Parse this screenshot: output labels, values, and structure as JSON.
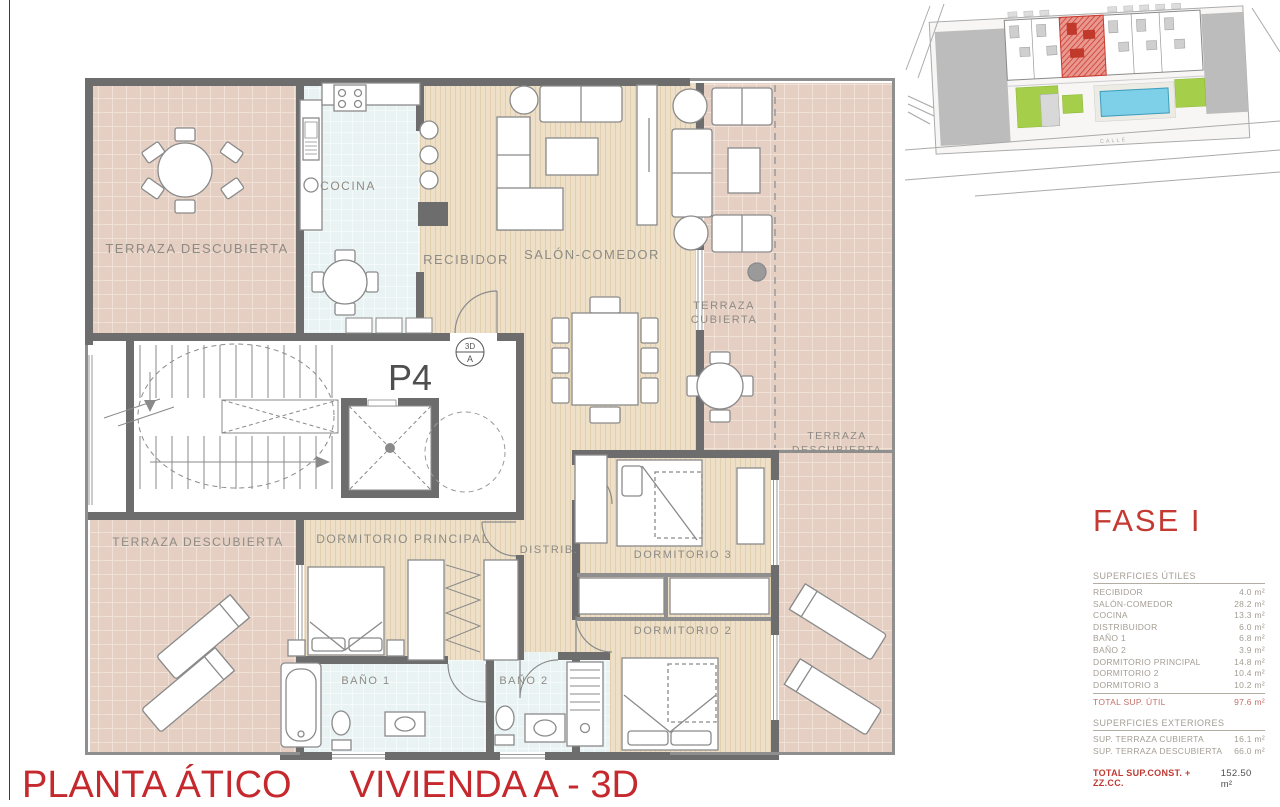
{
  "titles": {
    "plan_title": "PLANTA ÁTICO",
    "unit_title": "VIVIENDA A - 3D",
    "phase": "FASE I"
  },
  "floorplan": {
    "unit_label": "P4",
    "camera_marker": {
      "line1": "3D",
      "line2": "A"
    },
    "rooms": {
      "terraza_tl": "TERRAZA DESCUBIERTA",
      "cocina": "COCINA",
      "recibidor": "RECIBIDOR",
      "salon": "SALÓN-COMEDOR",
      "terraza_cub_1": "TERRAZA",
      "terraza_cub_2": "CUBIERTA",
      "terraza_der_1": "TERRAZA",
      "terraza_der_2": "DESCUBIERTA",
      "terraza_bl": "TERRAZA DESCUBIERTA",
      "dorm_principal": "DORMITORIO PRINCIPAL",
      "distrib": "DISTRIB.",
      "dorm3": "DORMITORIO 3",
      "dorm2": "DORMITORIO 2",
      "bano1": "BAÑO 1",
      "bano2": "BAÑO 2"
    }
  },
  "siteplan": {
    "street_label": "CALLE"
  },
  "surfaces": {
    "useful": {
      "title": "SUPERFICIES ÚTILES",
      "rows": [
        {
          "label": "RECIBIDOR",
          "value": "4.0 m²"
        },
        {
          "label": "SALÓN-COMEDOR",
          "value": "28.2 m²"
        },
        {
          "label": "COCINA",
          "value": "13.3 m²"
        },
        {
          "label": "DISTRIBUIDOR",
          "value": "6.0 m²"
        },
        {
          "label": "BAÑO 1",
          "value": "6.8 m²"
        },
        {
          "label": "BAÑO 2",
          "value": "3.9 m²"
        },
        {
          "label": "DORMITORIO PRINCIPAL",
          "value": "14.8 m²"
        },
        {
          "label": "DORMITORIO 2",
          "value": "10.4 m²"
        },
        {
          "label": "DORMITORIO 3",
          "value": "10.2 m²"
        }
      ],
      "total": {
        "label": "TOTAL SUP. ÚTIL",
        "value": "97.6 m²"
      }
    },
    "exterior": {
      "title": "SUPERFICIES EXTERIORES",
      "rows": [
        {
          "label": "SUP. TERRAZA CUBIERTA",
          "value": "16.1 m²"
        },
        {
          "label": "SUP. TERRAZA DESCUBIERTA",
          "value": "66.0 m²"
        }
      ]
    },
    "grand_total": {
      "label": "TOTAL SUP.CONST. + ZZ.CC.",
      "value": "152.50 m²"
    }
  },
  "colors": {
    "accent_red": "#c43a33",
    "wall": "#6d6d6d",
    "terrace_tile": "#e5cfc3",
    "wood": "#eee0c8",
    "wet_tile": "#eaf3f4",
    "pool_blue": "#7ecfe8",
    "garden_green": "#a5cf4a",
    "highlight_red": "#cc3b30"
  }
}
